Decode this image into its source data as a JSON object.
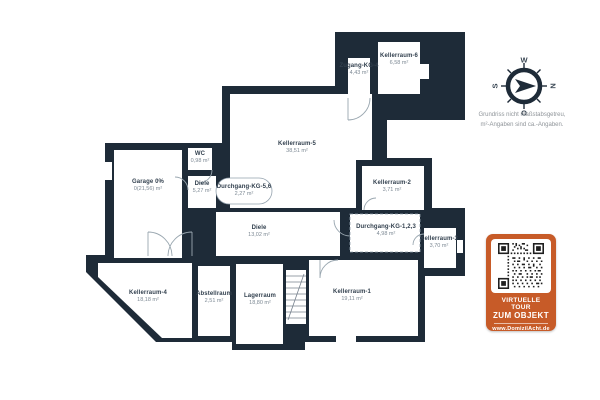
{
  "rooms": [
    {
      "id": "zugang-kg-4",
      "name": "Zugang-KG-4",
      "area": "4,43 m²"
    },
    {
      "id": "kellerraum-6",
      "name": "Kellerraum-6",
      "area": "6,58 m²"
    },
    {
      "id": "kellerraum-5",
      "name": "Kellerraum-5",
      "area": "38,51 m²"
    },
    {
      "id": "kellerraum-2",
      "name": "Kellerraum-2",
      "area": "3,71 m²"
    },
    {
      "id": "garage",
      "name": "Garage 0%",
      "area": "0(21,56) m²"
    },
    {
      "id": "wc",
      "name": "WC",
      "area": "0,98 m²"
    },
    {
      "id": "diele-og",
      "name": "Diele",
      "area": "5,27 m²"
    },
    {
      "id": "durchgang-kg-56",
      "name": "Durchgang-KG-5,6",
      "area": "2,27 m²"
    },
    {
      "id": "diele-main",
      "name": "Diele",
      "area": "13,02 m²"
    },
    {
      "id": "durchgang-kg-123",
      "name": "Durchgang-KG-1,2,3",
      "area": "4,98 m²"
    },
    {
      "id": "kellerraum-3",
      "name": "Kellerraum-3",
      "area": "3,70 m²"
    },
    {
      "id": "kellerraum-4",
      "name": "Kellerraum-4",
      "area": "18,18 m²"
    },
    {
      "id": "abstellraum",
      "name": "Abstellraum",
      "area": "2,51 m²"
    },
    {
      "id": "lagerraum",
      "name": "Lagerraum",
      "area": "18,80 m²"
    },
    {
      "id": "kellerraum-1",
      "name": "Kellerraum-1",
      "area": "19,11 m²"
    }
  ],
  "compass": {
    "n": "N",
    "o": "O",
    "s": "S",
    "w": "W"
  },
  "disclaimer": {
    "line1": "Grundriss nicht maßstabsgetreu,",
    "line2": "m²-Angaben sind ca.-Angaben."
  },
  "badge": {
    "line1": "VIRTUELLE TOUR",
    "line2": "ZUM OBJEKT",
    "url": "www.DomizilAcht.de"
  },
  "colors": {
    "wall": "#1e2b38",
    "accent_orange": "#c75b28"
  }
}
